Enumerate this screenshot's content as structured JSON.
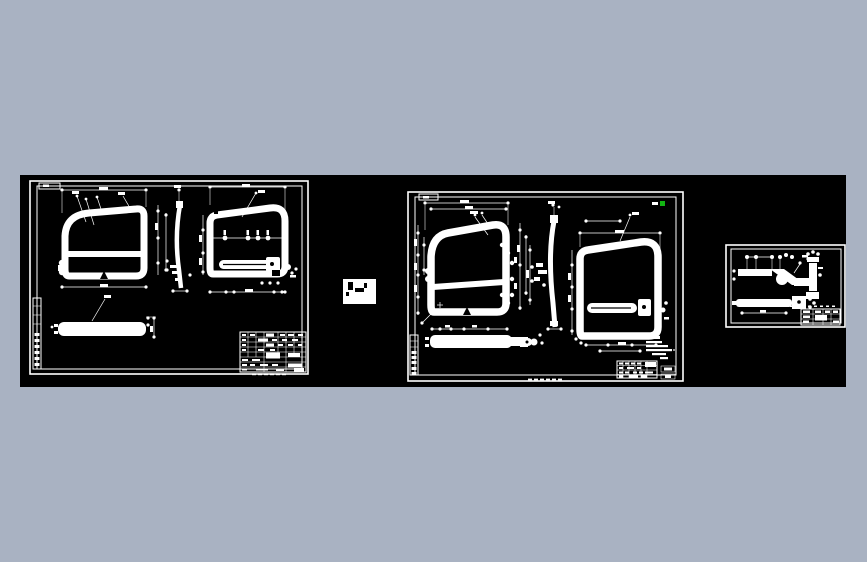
{
  "page": {
    "background_color": "#a9b2c2"
  },
  "canvas": {
    "background_color": "#000000",
    "line_color": "#ffffff",
    "highlight_color": "#12b412",
    "sheet_count": 3,
    "legible_text": ""
  },
  "sheets": [
    {
      "id": "sheet-1"
    },
    {
      "id": "sheet-2"
    },
    {
      "id": "sheet-3"
    }
  ]
}
